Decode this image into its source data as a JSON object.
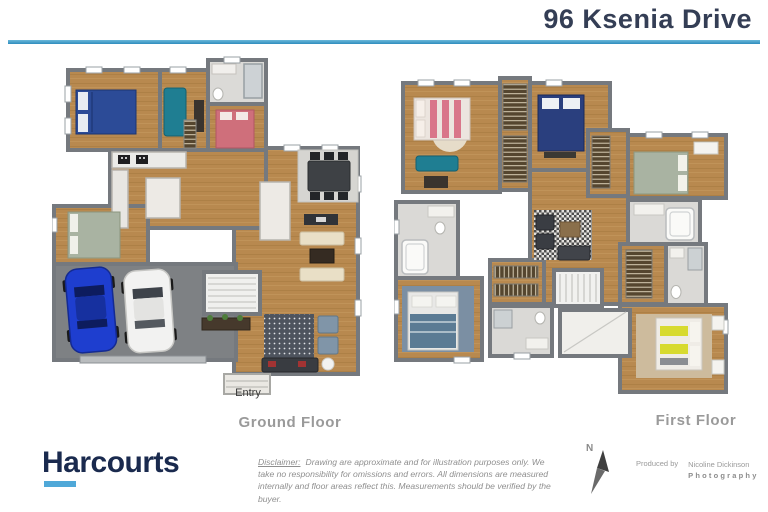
{
  "header": {
    "title": "96 Ksenia Drive",
    "accent_line_color": "#3F9CCB"
  },
  "plans": {
    "ground": {
      "label": "Ground Floor",
      "entry_label": "Entry"
    },
    "first": {
      "label": "First Floor"
    }
  },
  "footer": {
    "logo_text": "Harcourts",
    "logo_color": "#1A2A4E",
    "logo_underline_color": "#4FA8D8",
    "disclaimer_label": "Disclaimer:",
    "disclaimer_text": "Drawing are approximate and for illustration purposes only. We take no responsibility for omissions and errors.   All dimensions are measured internally and floor areas reflect this.   Measurements should be verified by the buyer.",
    "compass_label": "N",
    "produced_by": "Produced by",
    "producer_line1": "Nicoline Dickinson",
    "producer_line2": "Photography"
  },
  "palette": {
    "wood_floor": "#B8894F",
    "garage_floor": "#7E8184",
    "wall": "#75797E",
    "tile": "#DAD9D6",
    "blue_bed": "#2C4B97",
    "navy_bed": "#2A3F7E",
    "pink_bed": "#CF6F7B",
    "sage_bed": "#A9B3A2",
    "yellow_bed_stripe": "#D7DA2F",
    "teal_sofa": "#1F7E92",
    "cream_sofa": "#E9DFC6",
    "blue_car": "#1E3ECF",
    "white_car": "#F2F2F1"
  }
}
